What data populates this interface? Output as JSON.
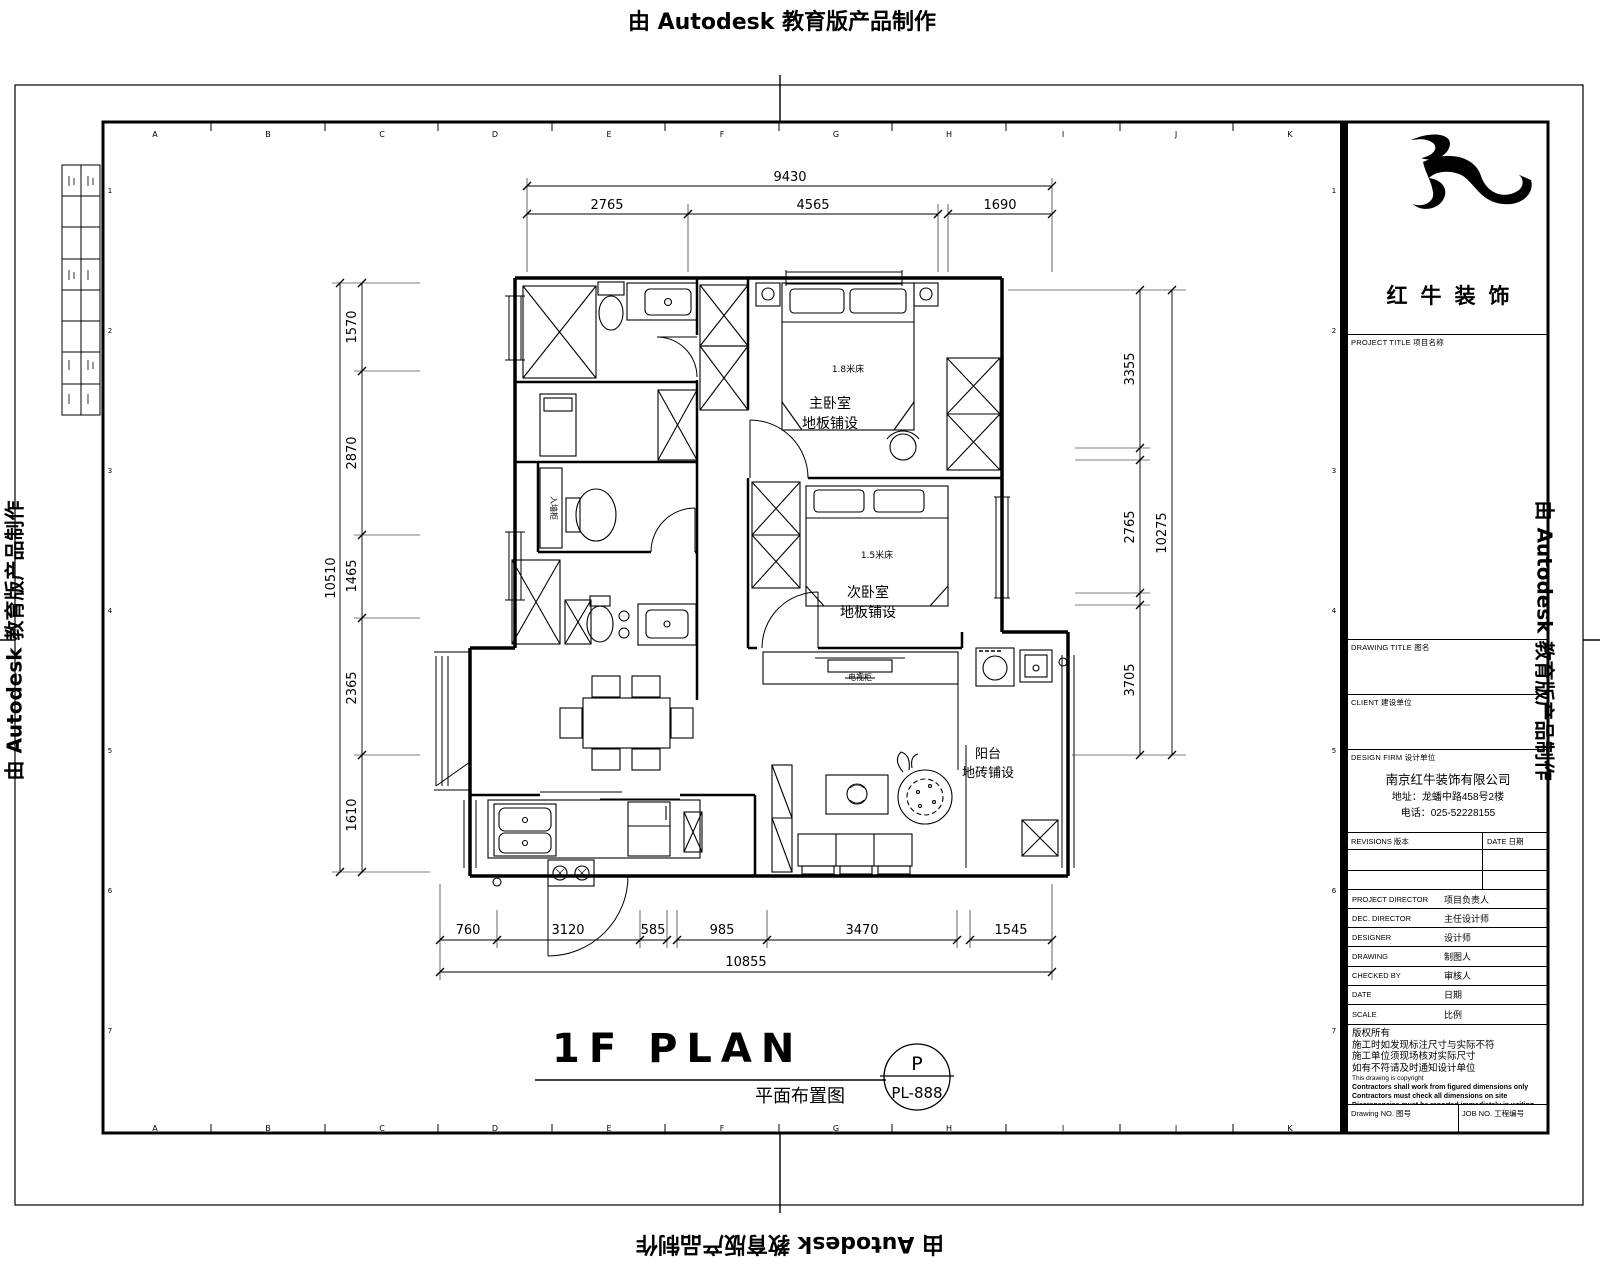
{
  "watermark": {
    "text": "由 Autodesk 教育版产品制作"
  },
  "sheet": {
    "grid_letters": [
      "A",
      "B",
      "C",
      "D",
      "E",
      "F",
      "G",
      "H",
      "I",
      "J",
      "K"
    ],
    "grid_numbers": [
      "1",
      "2",
      "3",
      "4",
      "5",
      "6",
      "7"
    ]
  },
  "title_block": {
    "logo_name": "红牛装饰",
    "headers": {
      "project_title": "PROJECT TITLE 项目名称",
      "drawing_title": "DRAWING TITLE 图名",
      "client": "CLIENT 建设单位",
      "design_firm": "DESIGN FIRM 设计单位"
    },
    "firm": {
      "name": "南京红牛装饰有限公司",
      "address": "地址：龙蟠中路458号2楼",
      "phone": "电话：025-52228155"
    },
    "revisions_header": {
      "revisions": "REVISIONS 版本",
      "date": "DATE 日期"
    },
    "rows": [
      {
        "en": "PROJECT DIRECTOR",
        "zh": "项目负责人"
      },
      {
        "en": "DEC. DIRECTOR",
        "zh": "主任设计师"
      },
      {
        "en": "DESIGNER",
        "zh": "设计师"
      },
      {
        "en": "DRAWING",
        "zh": "制图人"
      },
      {
        "en": "CHECKED BY",
        "zh": "审核人"
      },
      {
        "en": "DATE",
        "zh": "日期"
      },
      {
        "en": "SCALE",
        "zh": "比例"
      }
    ],
    "notes_zh": [
      "版权所有",
      "施工时如发现标注尺寸与实际不符",
      "施工单位须现场核对实际尺寸",
      "如有不符请及时通知设计单位"
    ],
    "notes_en_thin": "This drawing is copyright",
    "notes_en": [
      "Contractors shall work from figured dimensions only",
      "Contractors must check all dimensions on site",
      "Discrepancies must be reported immediately in writing"
    ],
    "footer": {
      "drawing_no": "Drawing NO. 图号",
      "job_no": "JOB NO. 工程编号"
    }
  },
  "plan": {
    "title_en": "1F PLAN",
    "title_zh": "平面布置图",
    "stamp": {
      "top": "P",
      "bottom": "PL-888"
    },
    "rooms": {
      "master_bedroom": {
        "name": "主卧室",
        "finish": "地板铺设",
        "bed": "1.8米床"
      },
      "second_bedroom": {
        "name": "次卧室",
        "finish": "地板铺设",
        "bed": "1.5米床"
      },
      "balcony": {
        "name": "阳台",
        "finish": "地砖铺设"
      },
      "tv_cabinet": "电视柜",
      "wall_cabinet": "入墙柜"
    }
  },
  "dims": {
    "top": {
      "overall": "9430",
      "segments": [
        "2765",
        "4565",
        "1690"
      ]
    },
    "left": {
      "overall": "10510",
      "segments": [
        "1570",
        "2870",
        "1465",
        "2365",
        "1610"
      ]
    },
    "right": {
      "overall": "10275",
      "segments": [
        "3355",
        "2765",
        "3705"
      ]
    },
    "bottom": {
      "overall": "10855",
      "segments": [
        "760",
        "3120",
        "585",
        "985",
        "3470",
        "1545"
      ]
    }
  }
}
